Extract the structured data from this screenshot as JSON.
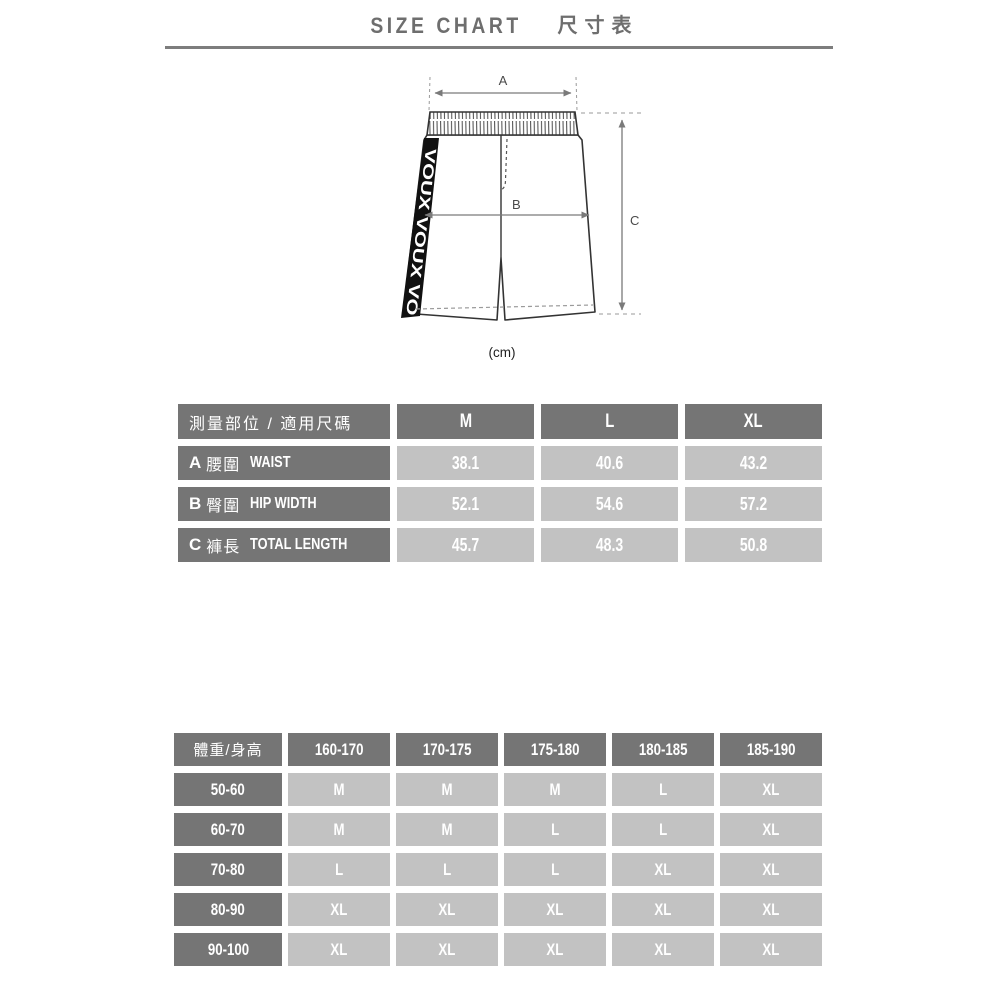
{
  "page": {
    "title_en": "SIZE CHART",
    "title_zh": "尺寸表"
  },
  "diagram": {
    "label_a": "A",
    "label_b": "B",
    "label_c": "C",
    "unit": "(cm)",
    "stripe_text": "VOUX VOUX VO"
  },
  "measure_table": {
    "corner_label": "測量部位 / 適用尺碼",
    "size_headers": [
      "M",
      "L",
      "XL"
    ],
    "rows": [
      {
        "key": "A",
        "name_zh": "腰圍",
        "name_en": "WAIST",
        "values": [
          "38.1",
          "40.6",
          "43.2"
        ]
      },
      {
        "key": "B",
        "name_zh": "臀圍",
        "name_en": "HIP WIDTH",
        "values": [
          "52.1",
          "54.6",
          "57.2"
        ]
      },
      {
        "key": "C",
        "name_zh": "褲長",
        "name_en": "TOTAL LENGTH",
        "values": [
          "45.7",
          "48.3",
          "50.8"
        ]
      }
    ]
  },
  "fit_table": {
    "corner_label": "體重/身高",
    "height_headers": [
      "160-170",
      "170-175",
      "175-180",
      "180-185",
      "185-190"
    ],
    "rows": [
      {
        "weight": "50-60",
        "sizes": [
          "M",
          "M",
          "M",
          "L",
          "XL"
        ]
      },
      {
        "weight": "60-70",
        "sizes": [
          "M",
          "M",
          "L",
          "L",
          "XL"
        ]
      },
      {
        "weight": "70-80",
        "sizes": [
          "L",
          "L",
          "L",
          "XL",
          "XL"
        ]
      },
      {
        "weight": "80-90",
        "sizes": [
          "XL",
          "XL",
          "XL",
          "XL",
          "XL"
        ]
      },
      {
        "weight": "90-100",
        "sizes": [
          "XL",
          "XL",
          "XL",
          "XL",
          "XL"
        ]
      }
    ]
  },
  "colors": {
    "header_cell": "#757575",
    "value_cell": "#c2c2c2",
    "cell_text": "#ffffff",
    "title_text": "#6e6e6e",
    "rule_line": "#7d7d7d",
    "stripe": "#111111",
    "drawing_outline": "#333333",
    "arrow": "#7a7a7a"
  }
}
